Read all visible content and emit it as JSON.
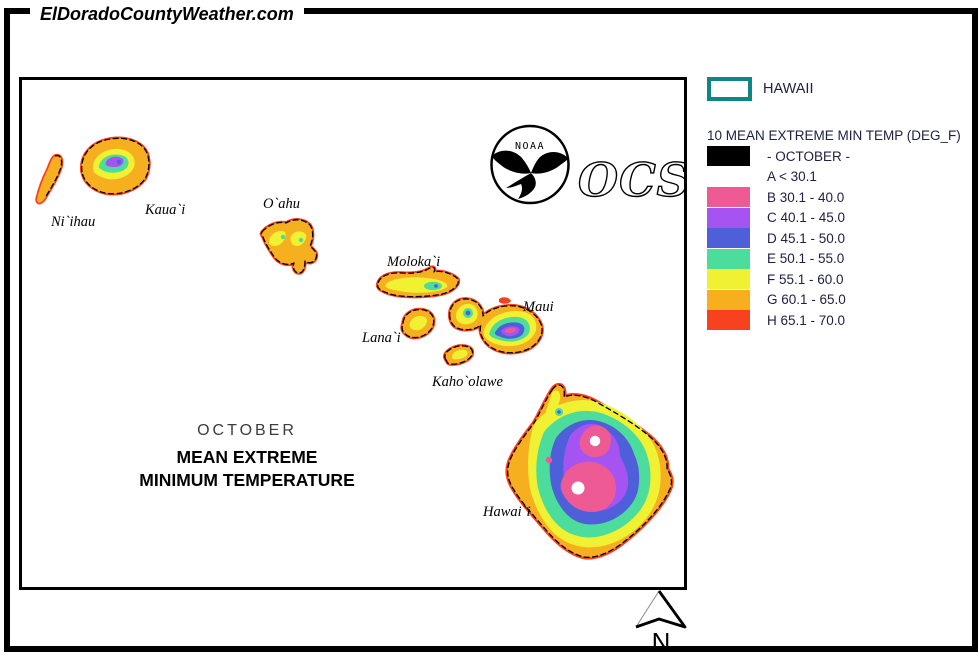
{
  "page": {
    "title": "ElDoradoCountyWeather.com"
  },
  "map": {
    "islands": [
      {
        "name": "Ni`ihau"
      },
      {
        "name": "Kaua`i"
      },
      {
        "name": "O`ahu"
      },
      {
        "name": "Moloka`i"
      },
      {
        "name": "Lana`i"
      },
      {
        "name": "Maui"
      },
      {
        "name": "Kaho`olawe"
      },
      {
        "name": "Hawai`i"
      }
    ],
    "caption": {
      "month": "OCTOBER",
      "line2": "MEAN EXTREME",
      "line3": "MINIMUM TEMPERATURE"
    },
    "noaa_label": "NOAA",
    "ocs_label": "OCS",
    "north_label": "N"
  },
  "legend": {
    "region_label": "HAWAII",
    "title": "10 MEAN EXTREME MIN TEMP (DEG_F)",
    "palette": {
      "black": "#000000",
      "white": "#FFFFFF",
      "pink": "#EE5A94",
      "purple": "#A554F2",
      "blue": "#4E5FD9",
      "green": "#4CDD9C",
      "yellow": "#F1F133",
      "orange": "#F6AF1F",
      "red": "#F6421E",
      "teal": "#0F8585",
      "legendText": "#202045"
    },
    "classes": [
      {
        "label": "- OCTOBER -",
        "colorKey": "black"
      },
      {
        "label": "A < 30.1",
        "colorKey": "white"
      },
      {
        "label": "B 30.1 - 40.0",
        "colorKey": "pink"
      },
      {
        "label": "C 40.1 - 45.0",
        "colorKey": "purple"
      },
      {
        "label": "D 45.1 - 50.0",
        "colorKey": "blue"
      },
      {
        "label": "E 50.1 - 55.0",
        "colorKey": "green"
      },
      {
        "label": "F 55.1 - 60.0",
        "colorKey": "yellow"
      },
      {
        "label": "G 60.1 - 65.0",
        "colorKey": "orange"
      },
      {
        "label": "H 65.1 - 70.0",
        "colorKey": "red"
      }
    ]
  }
}
